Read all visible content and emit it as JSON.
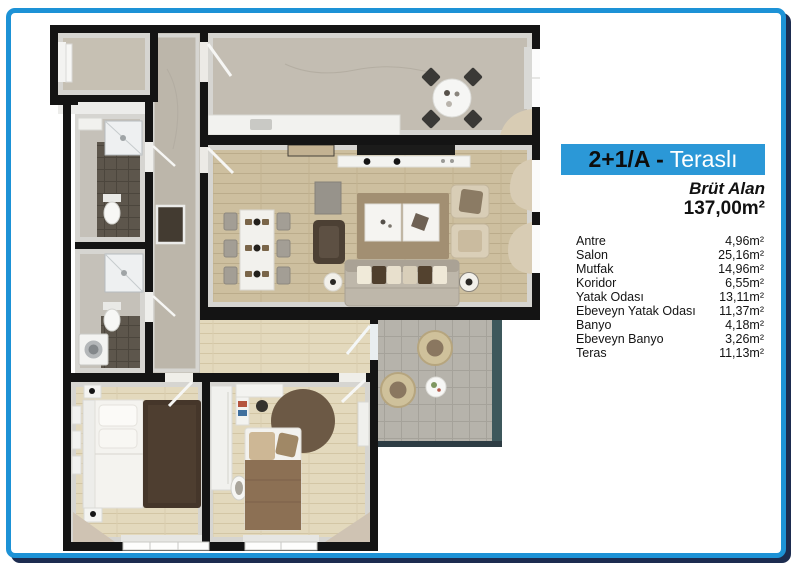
{
  "frame": {
    "border_color": "#1d92d6",
    "shadow_color": "#1d2c50"
  },
  "info_panel": {
    "banner": {
      "text_black": "2+1/A -",
      "text_white": "Teraslı",
      "bg_color": "#2b98d7"
    },
    "subtitle": "Brüt Alan",
    "gross_area": "137,00m²",
    "rooms": [
      {
        "name": "Antre",
        "area": "4,96m²"
      },
      {
        "name": "Salon",
        "area": "25,16m²"
      },
      {
        "name": "Mutfak",
        "area": "14,96m²"
      },
      {
        "name": "Koridor",
        "area": "6,55m²"
      },
      {
        "name": "Yatak Odası",
        "area": "13,11m²"
      },
      {
        "name": "Ebeveyn Yatak Odası",
        "area": "11,37m²"
      },
      {
        "name": "Banyo",
        "area": "4,18m²"
      },
      {
        "name": "Ebeveyn Banyo",
        "area": "3,26m²"
      },
      {
        "name": "Teras",
        "area": "11,13m²"
      }
    ]
  }
}
